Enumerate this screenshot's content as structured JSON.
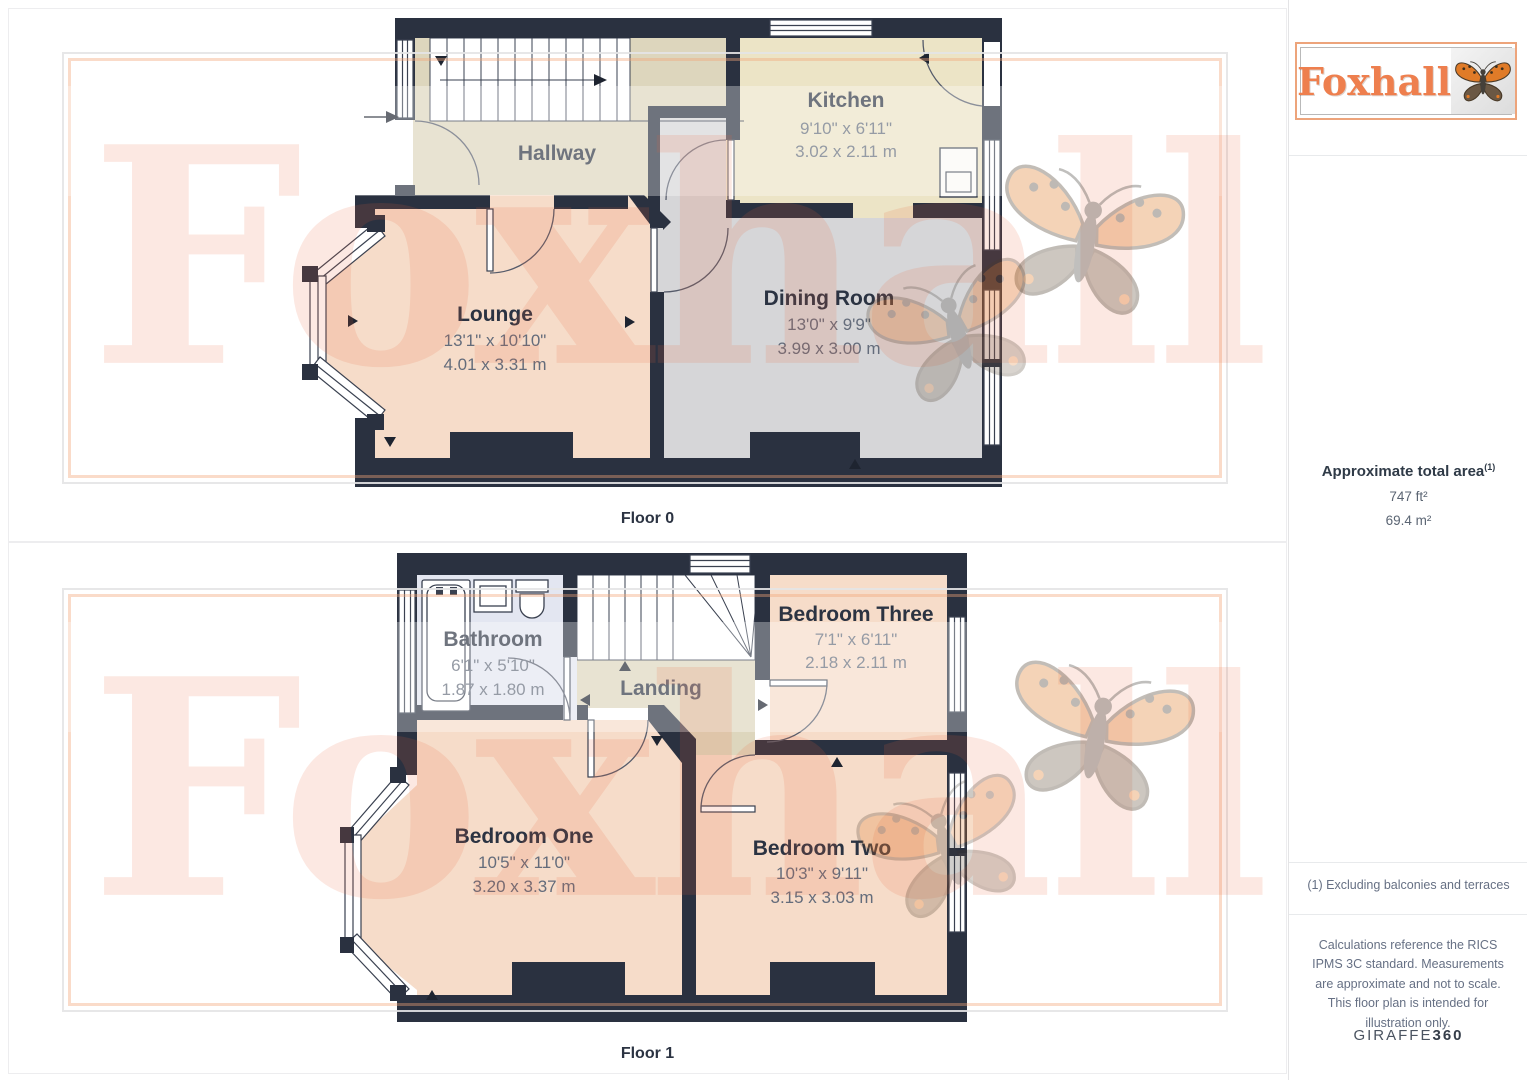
{
  "watermark": {
    "text": "Foxhall"
  },
  "sidebar": {
    "logo_text": "Foxhall",
    "area_title": "Approximate total area",
    "area_superscript": "(1)",
    "area_imperial": "747 ft²",
    "area_metric": "69.4 m²",
    "footnote": "(1) Excluding balconies and terraces",
    "disclaimer": "Calculations reference the RICS IPMS 3C standard. Measurements are approximate and not to scale. This floor plan is intended for illustration only.",
    "brand_name": "GIRAFFE",
    "brand_suffix": "360"
  },
  "floors": [
    {
      "label": "Floor 0",
      "rooms": {
        "hallway": {
          "name": "Hallway"
        },
        "kitchen": {
          "name": "Kitchen",
          "imperial": "9'10\" x 6'11\"",
          "metric": "3.02 x 2.11 m"
        },
        "lounge": {
          "name": "Lounge",
          "imperial": "13'1\" x 10'10\"",
          "metric": "4.01 x 3.31 m"
        },
        "dining": {
          "name": "Dining Room",
          "imperial": "13'0\" x 9'9\"",
          "metric": "3.99 x 3.00 m"
        }
      }
    },
    {
      "label": "Floor 1",
      "rooms": {
        "bathroom": {
          "name": "Bathroom",
          "imperial": "6'1\" x 5'10\"",
          "metric": "1.87 x 1.80 m"
        },
        "landing": {
          "name": "Landing"
        },
        "bedroom_three": {
          "name": "Bedroom Three",
          "imperial": "7'1\" x 6'11\"",
          "metric": "2.18 x 2.11 m"
        },
        "bedroom_one": {
          "name": "Bedroom One",
          "imperial": "10'5\" x 11'0\"",
          "metric": "3.20 x 3.37 m"
        },
        "bedroom_two": {
          "name": "Bedroom Two",
          "imperial": "10'3\" x 9'11\"",
          "metric": "3.15 x 3.03 m"
        }
      }
    }
  ],
  "palette": {
    "wall": "#2a3140",
    "room_salmon": "#f6dcc9",
    "room_tan": "#ddd6bd",
    "room_cream": "#ece4c6",
    "room_gray": "#d6d6d8",
    "room_lavender": "#e3e6f1",
    "label_text": "#2b3342",
    "dimension_text": "#646c7b",
    "brand_orange": "#ee7f4e"
  }
}
